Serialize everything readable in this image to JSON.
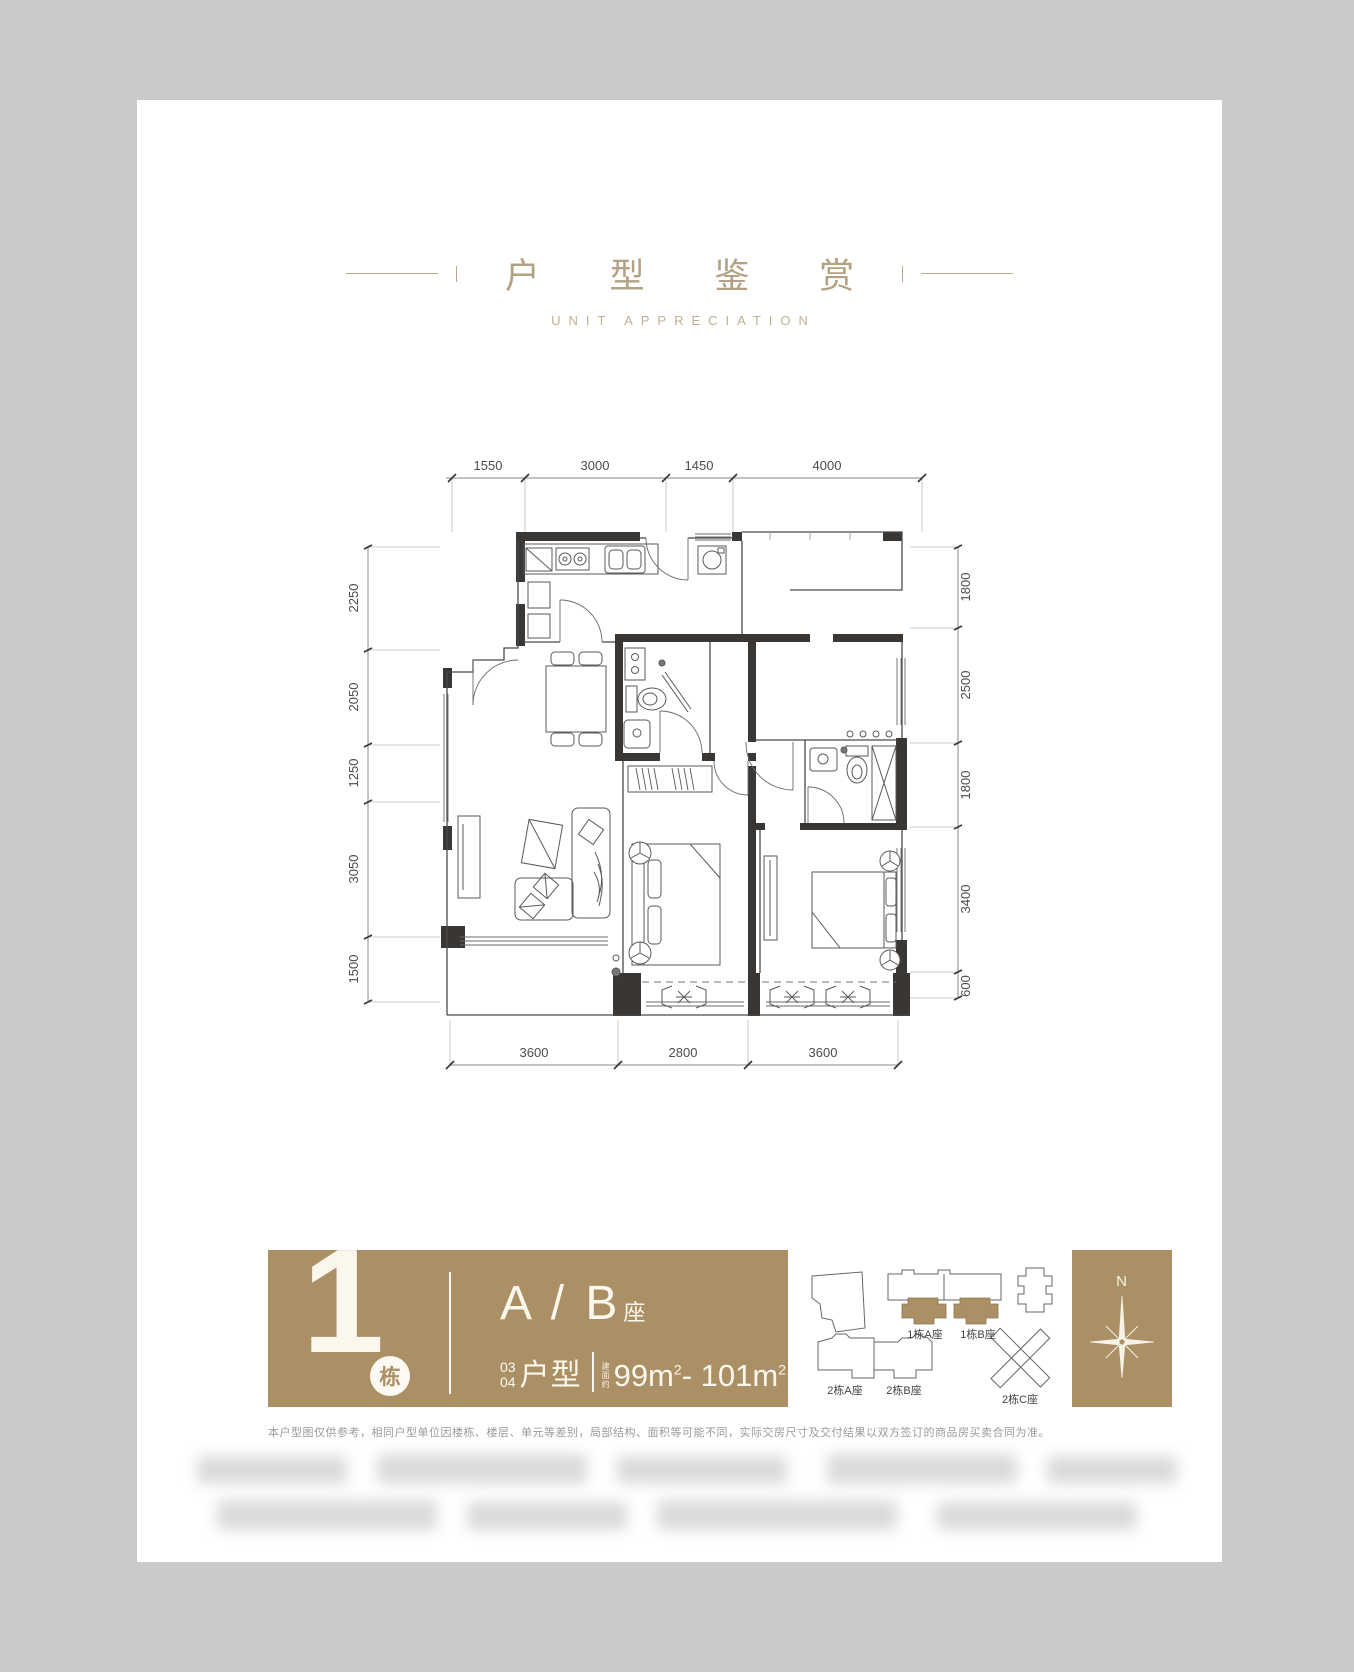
{
  "header": {
    "title": "户 型 鉴 赏",
    "subtitle": "UNIT APPRECIATION"
  },
  "floor_plan": {
    "dimensions_mm": {
      "top": [
        "1550",
        "3000",
        "1450",
        "4000"
      ],
      "left": [
        "2250",
        "2050",
        "1250",
        "3050",
        "1500"
      ],
      "right": [
        "1800",
        "2500",
        "1800",
        "3400",
        "600"
      ],
      "bottom": [
        "3600",
        "2800",
        "3600"
      ]
    }
  },
  "banner": {
    "building_number": "1",
    "building_unit_suffix": "栋",
    "block_label": "A / B",
    "block_suffix": "座",
    "unit_no_top": "03",
    "unit_no_bottom": "04",
    "unit_type_label": "户型",
    "area_prefix": "建面约",
    "area_from": "99m",
    "area_to": "101m",
    "area_superscript": "2",
    "area_separator": "-"
  },
  "key_plan": {
    "labels": [
      "1栋A座",
      "1栋B座",
      "2栋A座",
      "2栋B座",
      "2栋C座"
    ]
  },
  "compass": {
    "north_label": "N"
  },
  "disclaimer": "本户型图仅供参考，相同户型单位因楼栋、楼层、单元等差别，局部结构、面积等可能不同，实际交房尺寸及交付结果以双方签订的商品房买卖合同为准。",
  "colors": {
    "accent_gold": "#ab9066",
    "title_gold": "#b3a183",
    "wall_dark": "#3a3633",
    "canvas_bg": "#c9cac9"
  }
}
